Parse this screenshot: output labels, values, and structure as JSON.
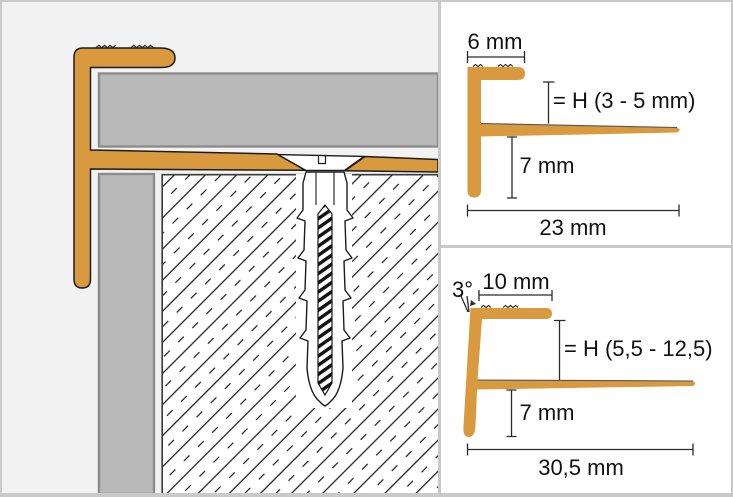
{
  "colors": {
    "profile_orange": "#D9993E",
    "outline": "#1C1C1C",
    "tile_fill": "#B9B9B9",
    "tile_border": "#8C8C8C",
    "left_background": "#F2F2F2",
    "panel_background": "#FFFFFF",
    "frame_border": "#C9C9C9",
    "dimension_line": "#2B2B2B"
  },
  "profile_diagrams": [
    {
      "top_width": "6 mm",
      "tile_height": "= H (3 - 5 mm)",
      "leg_height": "7 mm",
      "total_width": "23 mm"
    },
    {
      "angle": "3°",
      "top_width": "10 mm",
      "tile_height": "= H (5,5 - 12,5)",
      "leg_height": "7 mm",
      "total_width": "30,5 mm"
    }
  ]
}
